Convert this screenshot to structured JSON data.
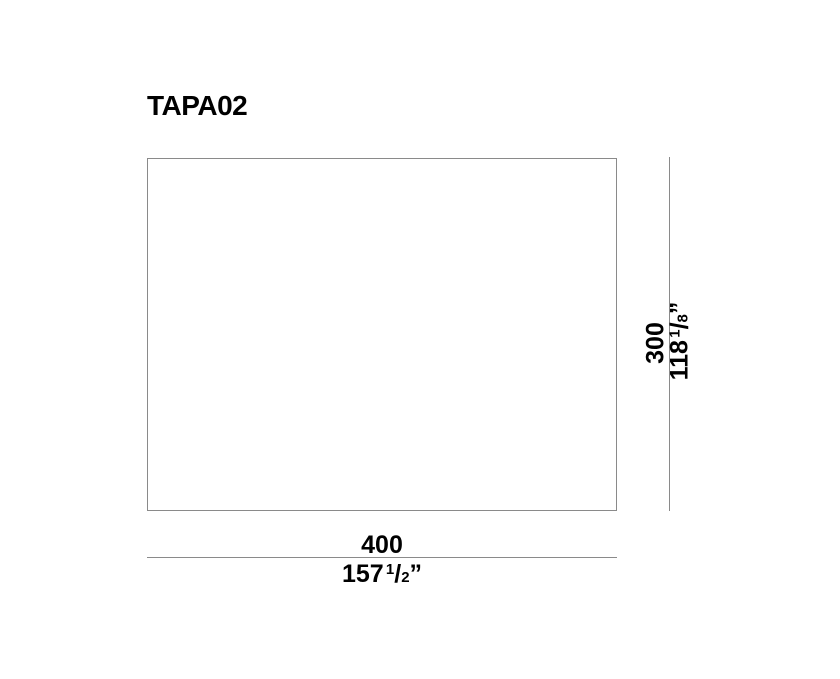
{
  "title": "TAPA02",
  "dimensions": {
    "width": {
      "metric": "400",
      "imperial_whole": "157",
      "imperial_numerator": "1",
      "imperial_denominator": "2",
      "imperial_unit": "”"
    },
    "height": {
      "metric": "300",
      "imperial_whole": "118",
      "imperial_numerator": "1",
      "imperial_denominator": "8",
      "imperial_unit": "”"
    }
  },
  "glyphs": {
    "fraction_slash": "/"
  },
  "colors": {
    "line": "#8a8a8a",
    "text": "#000000",
    "background": "#ffffff"
  }
}
